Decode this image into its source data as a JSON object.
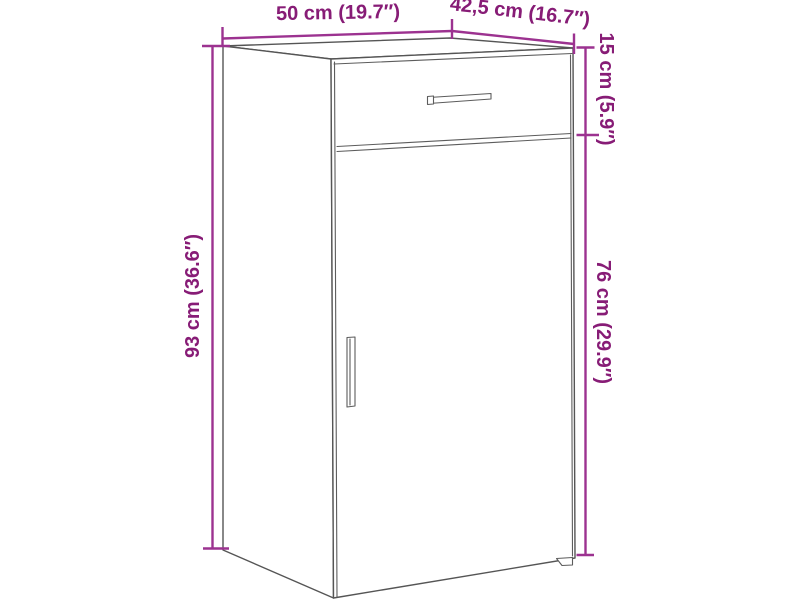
{
  "diagram": {
    "kind": "product-dimension-diagram",
    "subject": "cabinet with drawer and door",
    "labels": {
      "width": "50 cm (19.7″)",
      "depth": "42,5 cm (16.7″)",
      "height": "93 cm (36.6″)",
      "drawer": "15 cm (5.9″)",
      "door": "76 cm (29.9″)"
    },
    "dimensions": {
      "width": {
        "value_cm": "50",
        "value_in": "19.7"
      },
      "depth": {
        "value_cm": "42,5",
        "value_in": "16.7"
      },
      "height": {
        "value_cm": "93",
        "value_in": "36.6"
      },
      "drawer": {
        "value_cm": "15",
        "value_in": "5.9"
      },
      "door": {
        "value_cm": "76",
        "value_in": "29.9"
      }
    },
    "colors": {
      "dimension_text": "#871c76",
      "dimension_line": "#9c3290",
      "outline": "#555555",
      "background": "#ffffff"
    }
  }
}
